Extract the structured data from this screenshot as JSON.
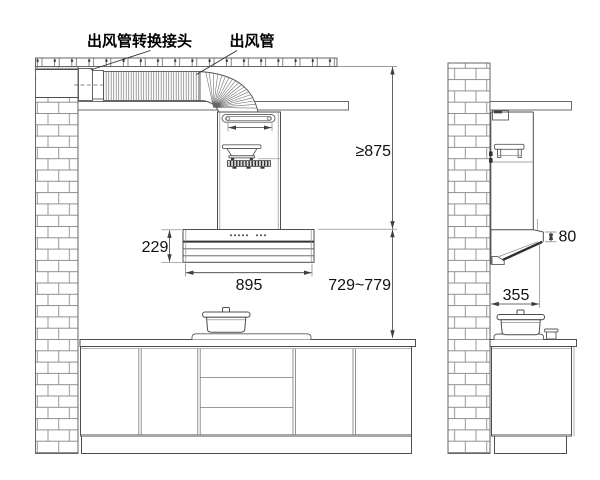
{
  "callouts": {
    "duct_adapter": "出风管转换接头",
    "duct": "出风管"
  },
  "dimensions": {
    "ceiling_to_hood_top": "≥875",
    "hood_height": "229",
    "hood_width": "895",
    "hood_top_to_countertop": "729~779",
    "hood_front_edge_height": "80",
    "hood_depth": "355"
  },
  "colors": {
    "background": "#ffffff",
    "line": "#4d4d4d",
    "dark_line": "#2e2e2e",
    "brick_line": "#8f8f8f",
    "text": "#111111"
  }
}
